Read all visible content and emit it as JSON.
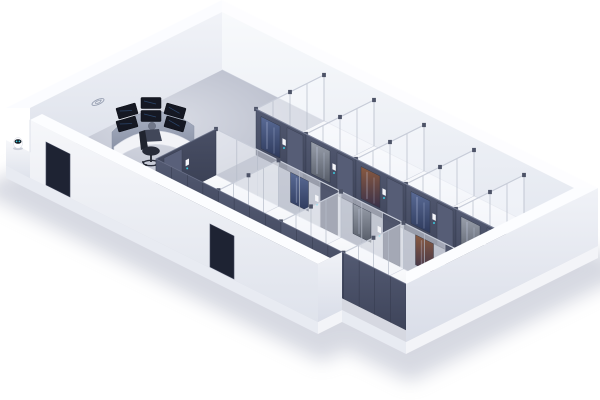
{
  "rooms": [
    {
      "id": "room-01",
      "number": "01"
    },
    {
      "id": "room-02",
      "number": "02"
    },
    {
      "id": "room-03",
      "number": "03"
    },
    {
      "id": "room-04",
      "number": "04"
    },
    {
      "id": "room-05",
      "number": "05"
    },
    {
      "id": "room-06",
      "number": "06"
    },
    {
      "id": "room-07",
      "number": "07"
    },
    {
      "id": "room-08",
      "number": "08"
    },
    {
      "id": "room-09",
      "number": "09"
    }
  ],
  "colors": {
    "accent_cyan": "#3AC8DC",
    "wall_dark": "#4A5066",
    "wall_dark_deep": "#3C4254",
    "door_exterior": "#1E2333",
    "glass_post": "#B6BCC9",
    "post_cap": "#4D5367",
    "number": "#B2B8C7",
    "floor_corridor": "#9BA1B3",
    "shadow": "#AEB3C5",
    "background": "#FFFFFF"
  }
}
